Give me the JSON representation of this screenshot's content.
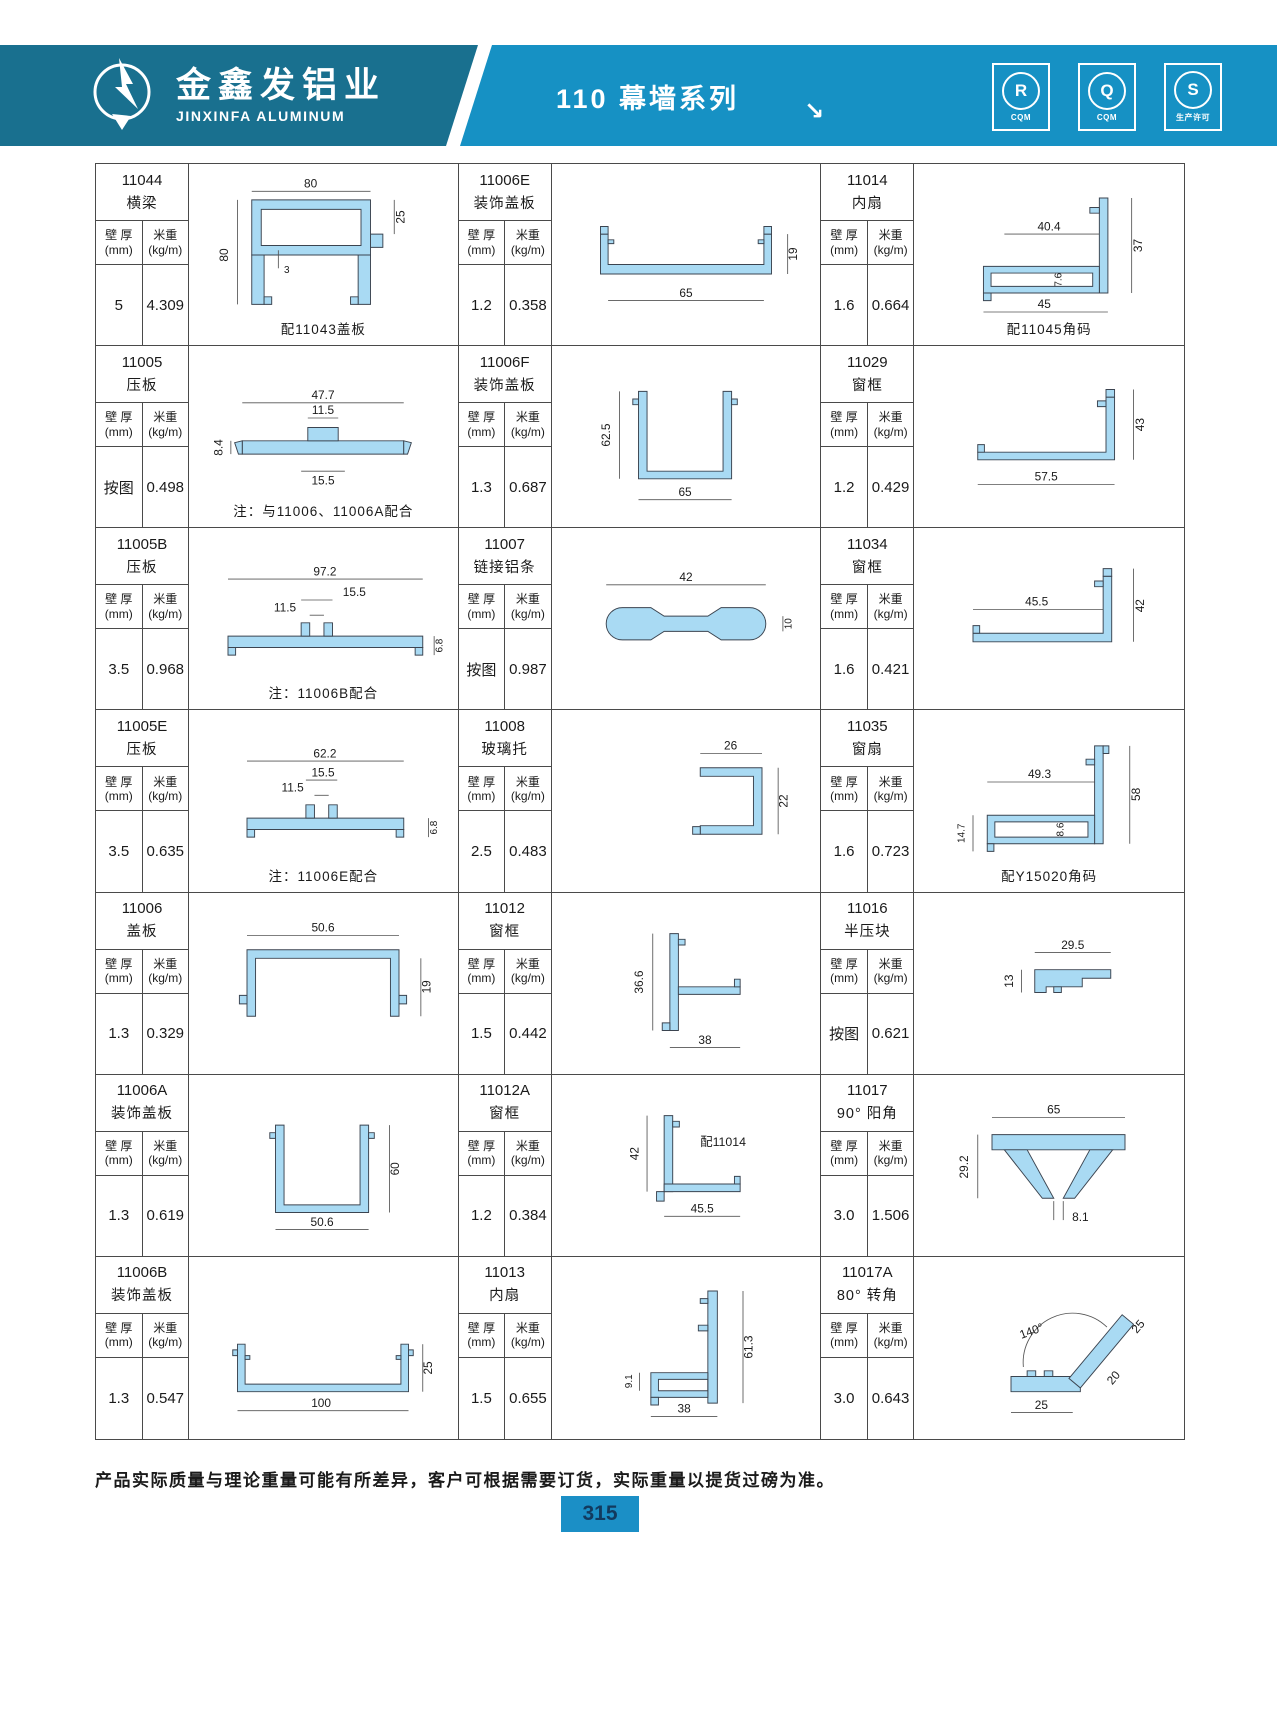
{
  "header": {
    "company_cn": "金鑫发铝业",
    "company_en": "JINXINFA ALUMINUM",
    "series_title": "110 幕墙系列",
    "arrow": "↘",
    "badges": [
      {
        "letter": "R",
        "sub": "CQM"
      },
      {
        "letter": "Q",
        "sub": "CQM"
      },
      {
        "letter": "S",
        "sub": "生产许可"
      }
    ]
  },
  "labels": {
    "thickness": "壁 厚",
    "thickness_unit": "(mm)",
    "weight": "米重",
    "weight_unit": "(kg/m)"
  },
  "products": [
    {
      "code": "11044",
      "name": "横梁",
      "thickness": "5",
      "weight": "4.309",
      "note": "配11043盖板",
      "dims": [
        "80",
        "80",
        "25",
        "3"
      ]
    },
    {
      "code": "11006E",
      "name": "装饰盖板",
      "thickness": "1.2",
      "weight": "0.358",
      "dims": [
        "65",
        "19"
      ]
    },
    {
      "code": "11014",
      "name": "内扇",
      "thickness": "1.6",
      "weight": "0.664",
      "note": "配11045角码",
      "dims": [
        "40.4",
        "37",
        "7.6",
        "45"
      ]
    },
    {
      "code": "11005",
      "name": "压板",
      "thickness": "按图",
      "weight": "0.498",
      "note": "注：与11006、11006A配合",
      "dims": [
        "47.7",
        "11.5",
        "8.4",
        "15.5"
      ]
    },
    {
      "code": "11006F",
      "name": "装饰盖板",
      "thickness": "1.3",
      "weight": "0.687",
      "dims": [
        "62.5",
        "65"
      ]
    },
    {
      "code": "11029",
      "name": "窗框",
      "thickness": "1.2",
      "weight": "0.429",
      "dims": [
        "43",
        "57.5"
      ]
    },
    {
      "code": "11005B",
      "name": "压板",
      "thickness": "3.5",
      "weight": "0.968",
      "note": "注：11006B配合",
      "dims": [
        "97.2",
        "15.5",
        "11.5",
        "6.8"
      ]
    },
    {
      "code": "11007",
      "name": "链接铝条",
      "thickness": "按图",
      "weight": "0.987",
      "dims": [
        "42",
        "10"
      ]
    },
    {
      "code": "11034",
      "name": "窗框",
      "thickness": "1.6",
      "weight": "0.421",
      "dims": [
        "45.5",
        "42"
      ]
    },
    {
      "code": "11005E",
      "name": "压板",
      "thickness": "3.5",
      "weight": "0.635",
      "note": "注：11006E配合",
      "dims": [
        "62.2",
        "15.5",
        "11.5",
        "6.8"
      ]
    },
    {
      "code": "11008",
      "name": "玻璃托",
      "thickness": "2.5",
      "weight": "0.483",
      "dims": [
        "26",
        "22"
      ]
    },
    {
      "code": "11035",
      "name": "窗扇",
      "thickness": "1.6",
      "weight": "0.723",
      "note": "配Y15020角码",
      "dims": [
        "49.3",
        "58",
        "8.6",
        "14.7"
      ]
    },
    {
      "code": "11006",
      "name": "盖板",
      "thickness": "1.3",
      "weight": "0.329",
      "dims": [
        "50.6",
        "19"
      ]
    },
    {
      "code": "11012",
      "name": "窗框",
      "thickness": "1.5",
      "weight": "0.442",
      "dims": [
        "36.6",
        "38"
      ]
    },
    {
      "code": "11016",
      "name": "半压块",
      "thickness": "按图",
      "weight": "0.621",
      "dims": [
        "29.5",
        "13"
      ]
    },
    {
      "code": "11006A",
      "name": "装饰盖板",
      "thickness": "1.3",
      "weight": "0.619",
      "dims": [
        "60",
        "50.6"
      ]
    },
    {
      "code": "11012A",
      "name": "窗框",
      "thickness": "1.2",
      "weight": "0.384",
      "note": "配11014",
      "dims": [
        "42",
        "45.5"
      ]
    },
    {
      "code": "11017",
      "name": "90° 阳角",
      "thickness": "3.0",
      "weight": "1.506",
      "dims": [
        "65",
        "29.2",
        "8.1"
      ]
    },
    {
      "code": "11006B",
      "name": "装饰盖板",
      "thickness": "1.3",
      "weight": "0.547",
      "dims": [
        "25",
        "100"
      ]
    },
    {
      "code": "11013",
      "name": "内扇",
      "thickness": "1.5",
      "weight": "0.655",
      "dims": [
        "9.1",
        "61.3",
        "38"
      ]
    },
    {
      "code": "11017A",
      "name": "80° 转角",
      "thickness": "3.0",
      "weight": "0.643",
      "dims": [
        "140°",
        "25",
        "20",
        "25"
      ]
    }
  ],
  "footer": {
    "note": "产品实际质量与理论重量可能有所差异，客户可根据需要订货，实际重量以提货过磅为准。",
    "page": "315"
  },
  "colors": {
    "band_left": "#19708f",
    "band_right": "#1691c4",
    "profile_fill": "#a9daf3",
    "page_box": "#1b8fc6"
  }
}
